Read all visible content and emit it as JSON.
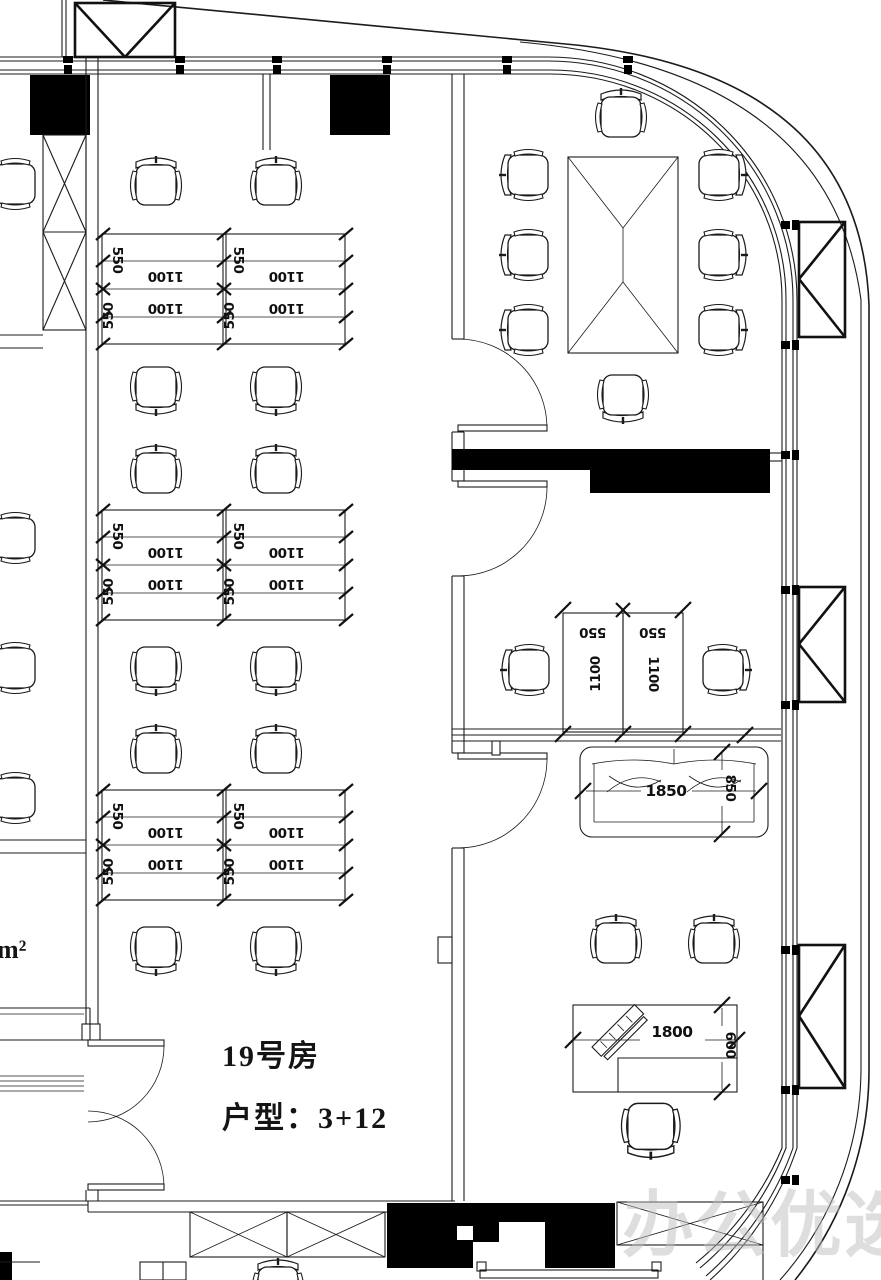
{
  "labels": {
    "room_number": "19号房",
    "unit_type": "户型：3+12",
    "area_partial": "0m²",
    "watermark": "办公优选"
  },
  "dims": {
    "d550": "550",
    "d1100": "1100",
    "d1850": "1850",
    "d850": "850",
    "d1800": "1800",
    "d600": "600"
  },
  "colors": {
    "line": "#1b1b1b",
    "solid_fill": "#000000",
    "watermark": "#bfbfbf",
    "paper": "#ffffff"
  }
}
